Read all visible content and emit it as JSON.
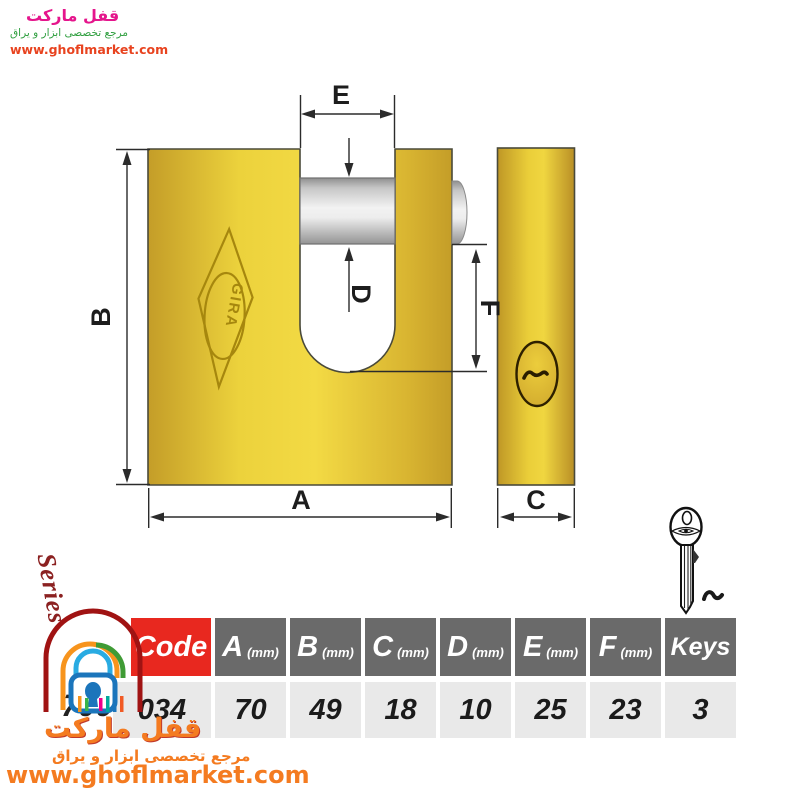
{
  "watermark_top": {
    "brand": "قفل مارکت",
    "tagline": "مرجع تخصصی ابزار و یراق",
    "url": "www.ghoflmarket.com"
  },
  "diagram": {
    "brand_engraving": "GIRA",
    "dim_labels": {
      "A": "A",
      "B": "B",
      "C": "C",
      "D": "D",
      "E": "E",
      "F": "F"
    }
  },
  "series": {
    "label": "Series",
    "value": "700"
  },
  "table": {
    "code": {
      "header": "Code",
      "value": "034"
    },
    "columns": [
      {
        "letter": "A",
        "unit": "(mm)",
        "value": "70"
      },
      {
        "letter": "B",
        "unit": "(mm)",
        "value": "49"
      },
      {
        "letter": "C",
        "unit": "(mm)",
        "value": "18"
      },
      {
        "letter": "D",
        "unit": "(mm)",
        "value": "10"
      },
      {
        "letter": "E",
        "unit": "(mm)",
        "value": "25"
      },
      {
        "letter": "F",
        "unit": "(mm)",
        "value": "23"
      }
    ],
    "keys": {
      "header": "Keys",
      "value": "3"
    }
  },
  "watermark_bottom": {
    "brand": "قفل مارکت",
    "tagline": "مرجع تخصصی ابزار و یراق",
    "url": "www.ghoflmarket.com"
  },
  "colors": {
    "body_gold": "#e9cd3a",
    "accent_red": "#e8281f",
    "header_gray": "#6a6a6a",
    "watermark_orange": "#f47b20"
  }
}
